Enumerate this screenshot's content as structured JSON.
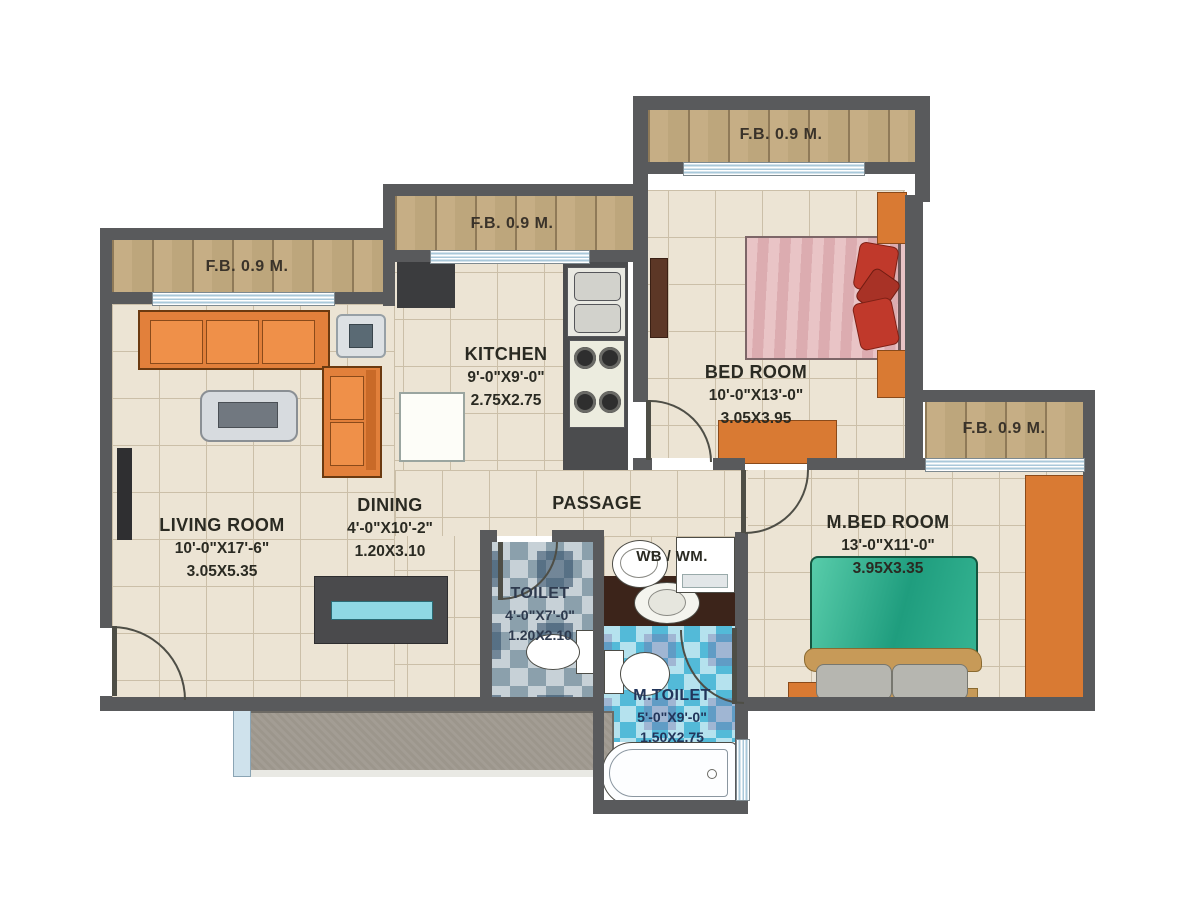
{
  "plan": {
    "flower_bed_label": "F.B. 0.9 M.",
    "rooms": {
      "living": {
        "name": "LIVING ROOM",
        "dim_ft": "10'-0\"X17'-6\"",
        "dim_m": "3.05X5.35"
      },
      "dining": {
        "name": "DINING",
        "dim_ft": "4'-0\"X10'-2\"",
        "dim_m": "1.20X3.10"
      },
      "kitchen": {
        "name": "KITCHEN",
        "dim_ft": "9'-0\"X9'-0\"",
        "dim_m": "2.75X2.75"
      },
      "bedroom": {
        "name": "BED ROOM",
        "dim_ft": "10'-0\"X13'-0\"",
        "dim_m": "3.05X3.95"
      },
      "master_bedroom": {
        "name": "M.BED ROOM",
        "dim_ft": "13'-0\"X11'-0\"",
        "dim_m": "3.95X3.35"
      },
      "toilet": {
        "name": "TOILET",
        "dim_ft": "4'-0\"X7'-0\"",
        "dim_m": "1.20X2.10"
      },
      "master_toilet": {
        "name": "M.TOILET",
        "dim_ft": "5'-0\"X9'-0\"",
        "dim_m": "1.50X2.75"
      },
      "passage": {
        "name": "PASSAGE"
      }
    },
    "fixtures": {
      "wb_wm": "WB / WM."
    },
    "colors": {
      "wall": "#595a5c",
      "floor": "#ece4d4",
      "wood_fb": "#c6ae85",
      "sofa_orange": "#e2803b",
      "wardrobe_orange": "#d97a33",
      "bed_pink": "#e7c3c6",
      "pillow_red": "#c0392b",
      "bed_green": "#2fae8e",
      "chair_purple": "#b49bc8",
      "table_cyan": "#8fd8e4",
      "toilet_tile": "#8ba0ac",
      "mtoilet_tile": "#53bad8",
      "vanity_brown": "#3c241a",
      "balcony_gray": "#9c968c"
    }
  }
}
